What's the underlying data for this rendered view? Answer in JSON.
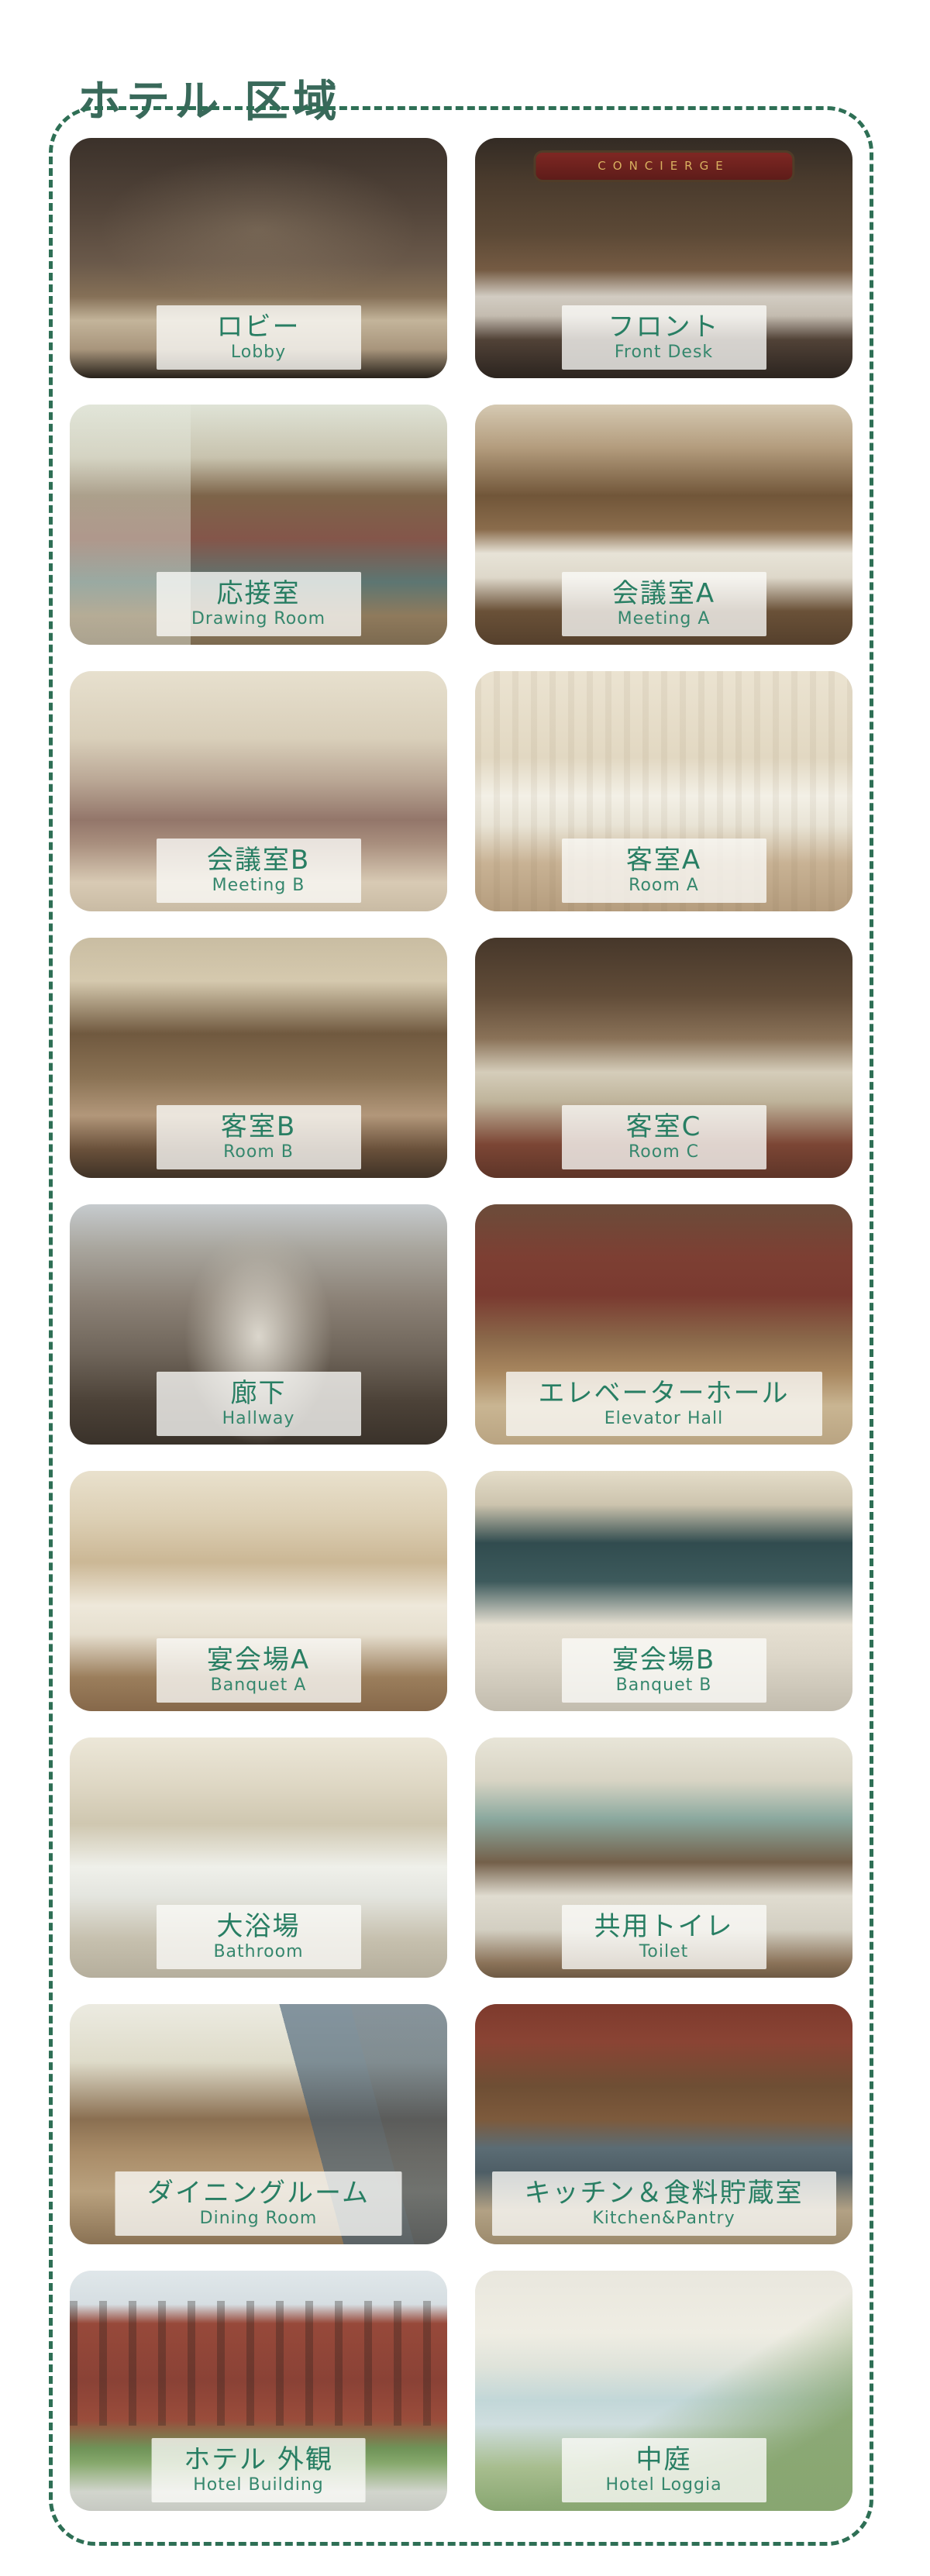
{
  "page": {
    "title": "ホテル 区域",
    "title_color": "#39695a",
    "border_color": "#2e6f55",
    "label_text_color": "#287e63",
    "label_bg": "rgba(251,251,249,0.78)"
  },
  "cards": [
    {
      "jp": "ロビー",
      "en": "Lobby",
      "alt": "Grand hotel lobby with ornate wooden staircase, sofas and checkered marble floor"
    },
    {
      "jp": "フロント",
      "en": "Front Desk",
      "alt": "Hotel front desk with key rack wall and red CONCIERGE sign",
      "sign": "CONCIERGE"
    },
    {
      "jp": "応接室",
      "en": "Drawing Room",
      "alt": "Bright drawing room with tall windows, fireplace, red sofas and teal rug"
    },
    {
      "jp": "会議室A",
      "en": "Meeting A",
      "alt": "Wood panelled meeting room with long white table and leather chairs"
    },
    {
      "jp": "会議室B",
      "en": "Meeting B",
      "alt": "Light meeting room with taupe tufted armchairs and flower vase"
    },
    {
      "jp": "客室A",
      "en": "Room A",
      "alt": "Bright guest bedroom with white bed, striped wallpaper and writing desk"
    },
    {
      "jp": "客室B",
      "en": "Room B",
      "alt": "Guest room with folding screen, round rug and scattered papers"
    },
    {
      "jp": "客室C",
      "en": "Room C",
      "alt": "Dark wood guest room with canopy four-poster bed and fireplace"
    },
    {
      "jp": "廊下",
      "en": "Hallway",
      "alt": "Long symmetrical hotel corridor with skylights and patterned floor"
    },
    {
      "jp": "エレベーターホール",
      "en": "Elevator Hall",
      "alt": "Elevator hall with wood panelling, red wallpaper and patterned carpet"
    },
    {
      "jp": "宴会場A",
      "en": "Banquet A",
      "alt": "Banquet hall A with many round dining tables, chandeliers and set tableware"
    },
    {
      "jp": "宴会場B",
      "en": "Banquet B",
      "alt": "Banquet hall B with dark teal curtains, balcony and open dance floor"
    },
    {
      "jp": "大浴場",
      "en": "Bathroom",
      "alt": "Large arched public bath hall with railings and ivory columns"
    },
    {
      "jp": "共用トイレ",
      "en": "Toilet",
      "alt": "Shared toilet room with arched mirrors, sinks, towels and flowers"
    },
    {
      "jp": "ダイニングルーム",
      "en": "Dining Room",
      "alt": "Dining room with round tables, dark blue curtain and chandelier"
    },
    {
      "jp": "キッチン＆食料貯蔵室",
      "en": "Kitchen&Pantry",
      "alt": "Brick kitchen and pantry with wooden shelves and central island"
    },
    {
      "jp": "ホテル 外観",
      "en": "Hotel Building",
      "alt": "Red brick hotel building exterior with arched windows and trees"
    },
    {
      "jp": "中庭",
      "en": "Hotel Loggia",
      "alt": "Hotel courtyard loggia with colonnade, reflecting pool and green lawn"
    }
  ]
}
